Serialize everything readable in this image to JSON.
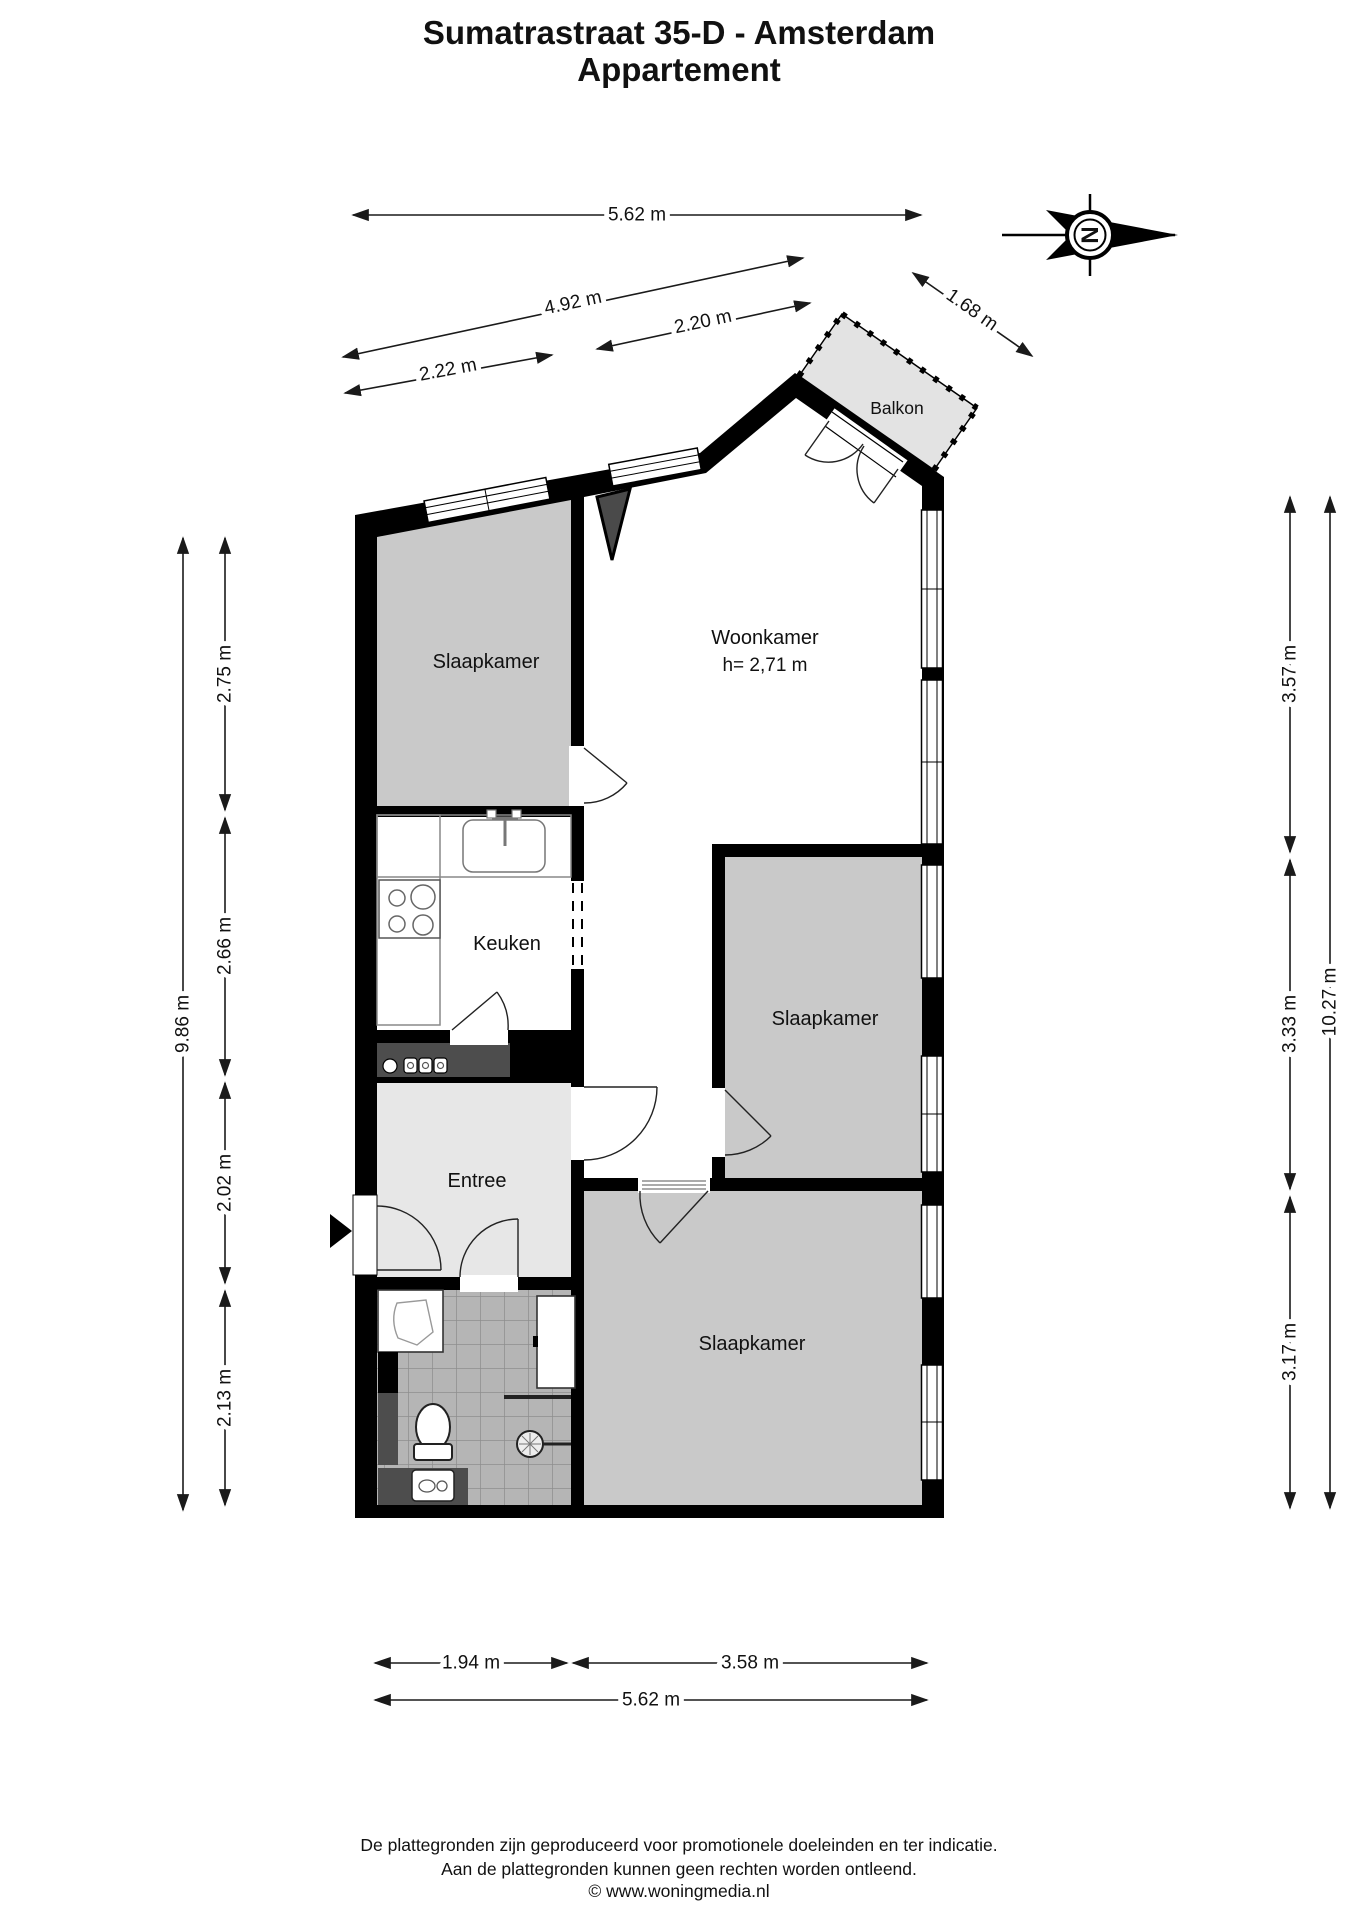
{
  "title": {
    "line1": "Sumatrastraat 35-D - Amsterdam",
    "line2": "Appartement"
  },
  "compass": {
    "letter": "N"
  },
  "rooms": {
    "woonkamer": {
      "label": "Woonkamer",
      "height_note": "h= 2,71 m"
    },
    "slaapkamer_1": {
      "label": "Slaapkamer"
    },
    "slaapkamer_2": {
      "label": "Slaapkamer"
    },
    "slaapkamer_3": {
      "label": "Slaapkamer"
    },
    "keuken": {
      "label": "Keuken"
    },
    "entree": {
      "label": "Entree"
    },
    "balkon": {
      "label": "Balkon"
    }
  },
  "dimensions": {
    "top": [
      {
        "label": "5.62 m"
      },
      {
        "label": "4.92 m"
      },
      {
        "label": "2.20 m"
      },
      {
        "label": "2.22 m"
      },
      {
        "label": "1.68 m"
      }
    ],
    "left": [
      {
        "label": "9.86 m"
      },
      {
        "label": "2.75 m"
      },
      {
        "label": "2.66 m"
      },
      {
        "label": "2.02 m"
      },
      {
        "label": "2.13 m"
      }
    ],
    "right": [
      {
        "label": "3.57 m"
      },
      {
        "label": "3.33 m"
      },
      {
        "label": "3.17 m"
      },
      {
        "label": "10.27 m"
      }
    ],
    "bottom": [
      {
        "label": "1.94 m"
      },
      {
        "label": "3.58 m"
      },
      {
        "label": "5.62 m"
      }
    ]
  },
  "footer": {
    "line1": "De plattegronden zijn geproduceerd voor promotionele doeleinden en ter indicatie.",
    "line2": "Aan de plattegronden kunnen geen rechten worden ontleend.",
    "line3": "© www.woningmedia.nl"
  },
  "colors": {
    "wall": "#000000",
    "bedroom_gray": "#c9c9c9",
    "entree_gray": "#e7e7e7",
    "tile_gray": "#b5b5b5",
    "dark_gray": "#4d4d4d",
    "balcony_gray": "#e3e3e3"
  }
}
